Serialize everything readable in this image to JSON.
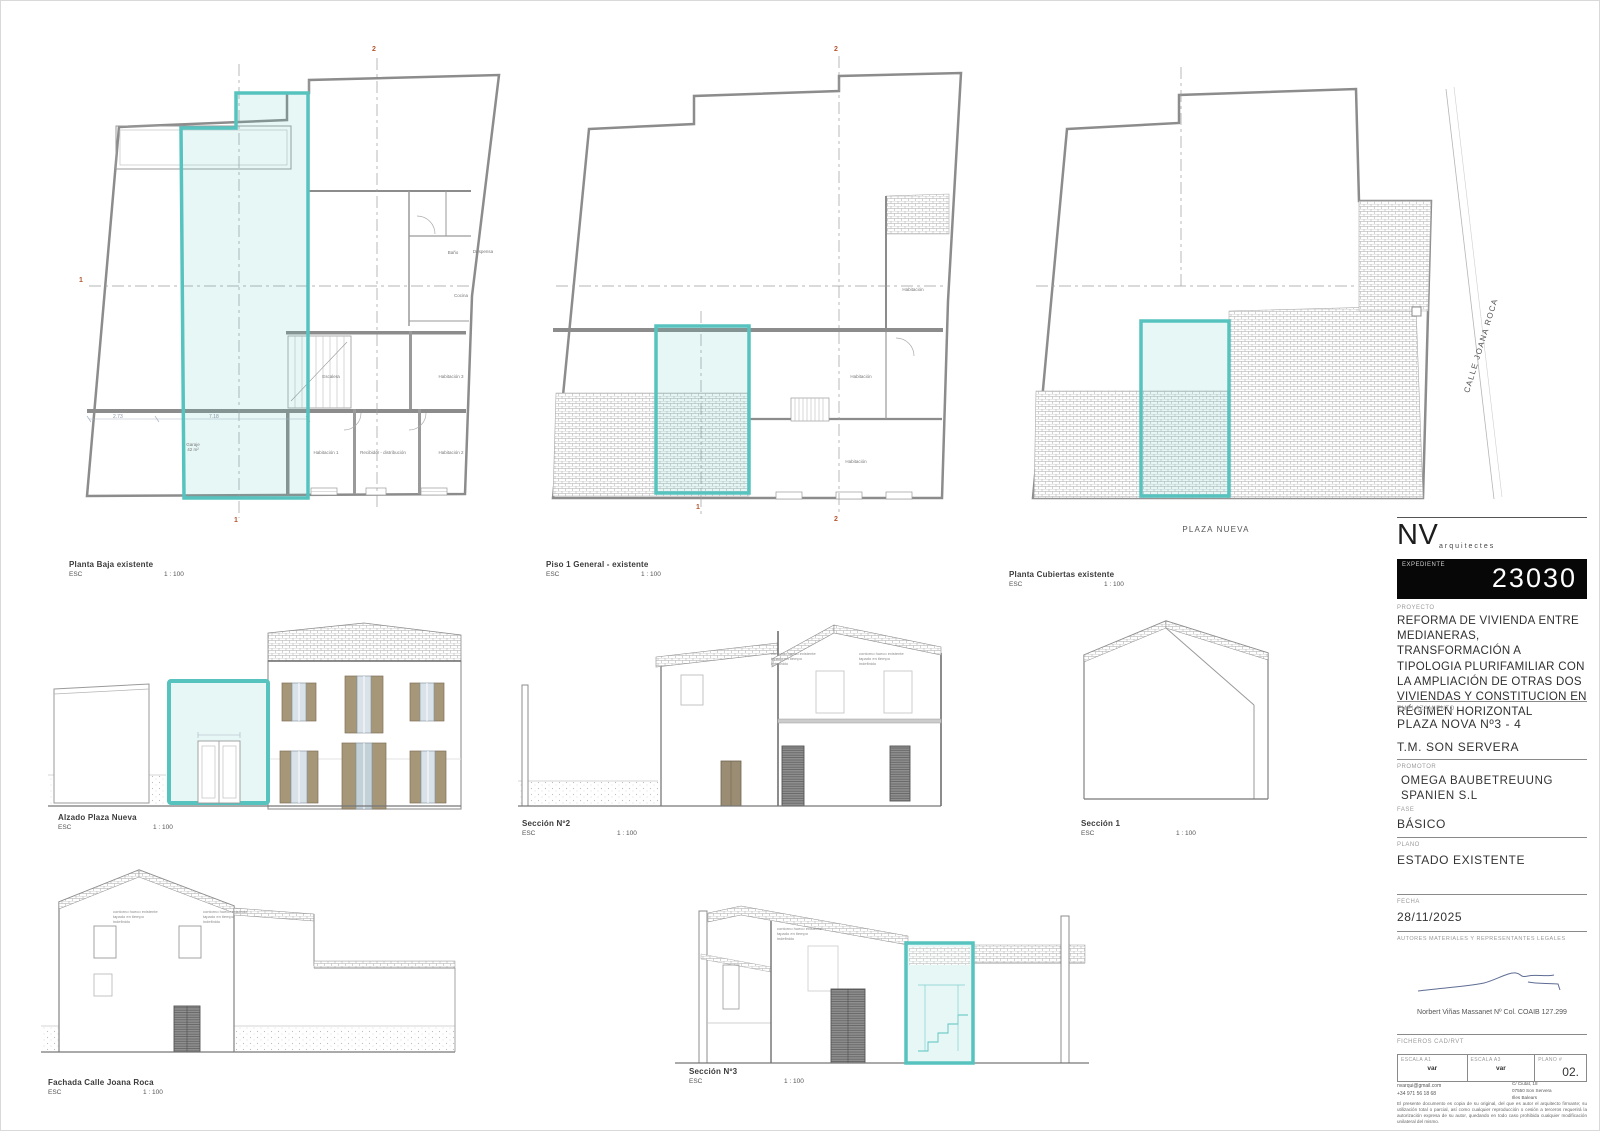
{
  "drawings": {
    "planta_baja": {
      "title": "Planta Baja existente",
      "esc": "ESC",
      "scale": "1 : 100"
    },
    "piso1": {
      "title": "Piso 1 General - existente",
      "esc": "ESC",
      "scale": "1 : 100"
    },
    "cubiertas": {
      "title": "Planta Cubiertas existente",
      "esc": "ESC",
      "scale": "1 : 100"
    },
    "alzado": {
      "title": "Alzado Plaza Nueva",
      "esc": "ESC",
      "scale": "1 : 100"
    },
    "seccion2": {
      "title": "Sección Nº2",
      "esc": "ESC",
      "scale": "1 : 100"
    },
    "seccion1": {
      "title": "Sección 1",
      "esc": "ESC",
      "scale": "1 : 100"
    },
    "fachada": {
      "title": "Fachada Calle Joana Roca",
      "esc": "ESC",
      "scale": "1 : 100"
    },
    "seccion3": {
      "title": "Sección Nº3",
      "esc": "ESC",
      "scale": "1 : 100"
    }
  },
  "streets": {
    "plaza_nueva": "PLAZA NUEVA",
    "calle_joana_roca": "CALLE JOANA ROCA"
  },
  "rooms": {
    "garaje_name": "Garaje",
    "garaje_area": "42 m²",
    "hab1": "Habitación 1",
    "hab2": "Habitación 2",
    "hab3": "Habitación 3",
    "recibidor": "Recibidor - distribución",
    "escalera": "Escalera",
    "bano": "Baño",
    "despensa": "Despensa",
    "cocina": "Cocina",
    "habitacion": "Habitación"
  },
  "dims": {
    "d273": "2.73",
    "d718": "7.18"
  },
  "markers": {
    "m1": "1",
    "m2": "2"
  },
  "notes": {
    "hueco": "contorno hueco existente tapado en tiempo indefinido"
  },
  "titleblock": {
    "logo_main": "NV",
    "logo_sub": "arquitectes",
    "expediente_label": "EXPEDIENTE",
    "expediente_value": "23030",
    "proyecto_label": "PROYECTO",
    "proyecto_text": "REFORMA DE VIVIENDA ENTRE MEDIANERAS, TRANSFORMACIÓN A TIPOLOGIA PLURIFAMILIAR CON LA AMPLIACIÓN DE OTRAS DOS VIVIENDAS Y CONSTITUCION EN RÉGIMEN HORIZONTAL",
    "emplazamiento_label": "EMPLAZAMIENTO",
    "emplazamiento_line1": "PLAZA NOVA Nº3 - 4",
    "emplazamiento_line2": "T.M. SON SERVERA",
    "promotor_label": "PROMOTOR",
    "promotor_line1": "OMEGA BAUBETREUUNG",
    "promotor_line2": "SPANIEN S.L",
    "fase_label": "FASE",
    "fase_value": "BÁSICO",
    "plano_label": "PLANO",
    "plano_value": "ESTADO EXISTENTE",
    "fecha_label": "FECHA",
    "fecha_value": "28/11/2025",
    "autores_label": "AUTORES MATERIALES Y REPRESENTANTES LEGALES",
    "firmante": "Norbert Viñas Massanet  Nº Col. COAIB 127.299",
    "ficheros_label": "FICHEROS CAD/RVT",
    "escala_a1_label": "ESCALA A1",
    "escala_a1_value": "var",
    "escala_a3_label": "ESCALA A3",
    "escala_a3_value": "var",
    "plano_num_label": "PLANO #",
    "plano_num_value": "02.",
    "email": "nvarqui@gmail.com",
    "phone": "+34 971 56 18 68",
    "address_line1": "C/ Ciutat, 18",
    "address_line2": "07550 Son Servera",
    "address_line3": "Illes Balears",
    "disclaimer": "El presente documento es copia de su original, del que es autor el arquitecto firmante; su utilización total o parcial, así como cualquier reproducción o cesión a terceros requerirá la autorización expresa de su autor, quedando en todo caso prohibida cualquier modificación unilateral del mismo."
  },
  "colors": {
    "highlight": "#57c3bf",
    "marker": "#b2562f",
    "expediente_bg": "#070707"
  }
}
